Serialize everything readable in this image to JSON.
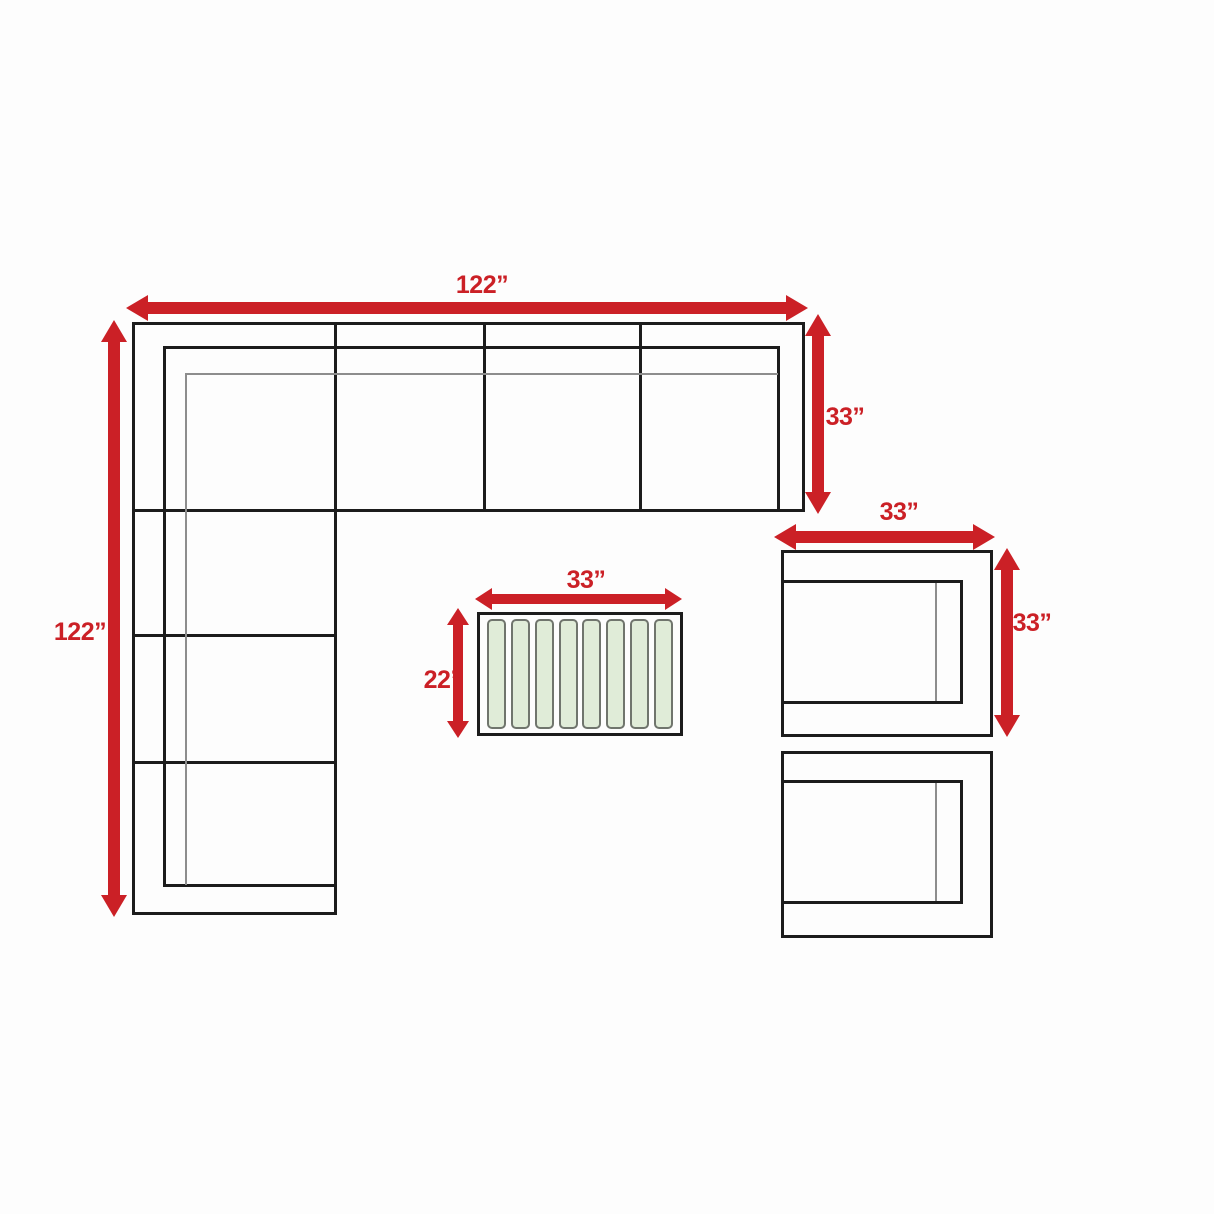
{
  "colors": {
    "dimension_red": "#cb2026",
    "outline_black": "#1c1c1c",
    "cushion_gray": "#8d8d8d",
    "slat_fill": "#e0ecd8",
    "slat_border": "#70756d",
    "background": "#fdfdfd"
  },
  "dimensions": {
    "sofa_width": "122”",
    "sofa_length": "122”",
    "sofa_depth": "33”",
    "chair_width": "33”",
    "chair_depth": "33”",
    "table_width": "33”",
    "table_depth": "22”"
  },
  "furniture": {
    "sectional_sofa": {
      "top_sections": 4,
      "left_sections": 4
    },
    "coffee_table": {
      "slat_count": 8
    },
    "armless_chairs": {
      "count": 2
    }
  }
}
